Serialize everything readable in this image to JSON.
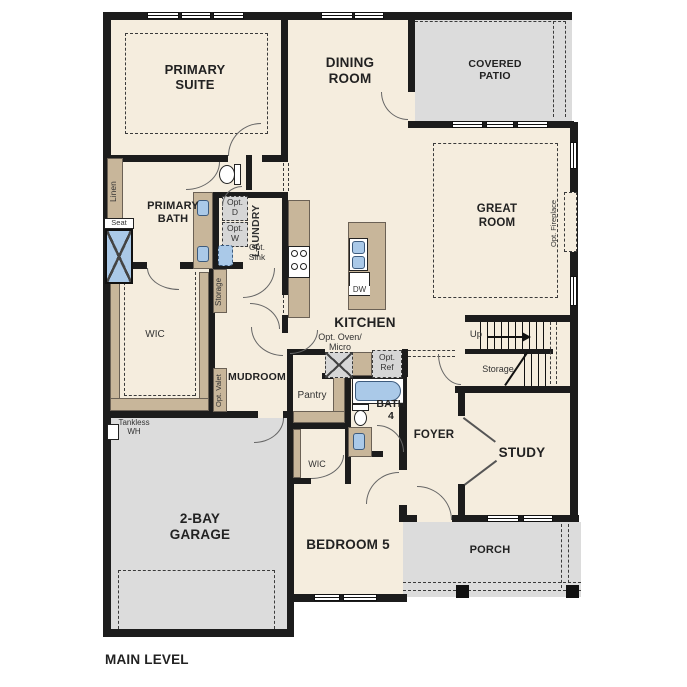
{
  "plan": {
    "title": "MAIN LEVEL",
    "rooms": {
      "primary_suite": "PRIMARY SUITE",
      "dining_room": "DINING ROOM",
      "covered_patio": "COVERED PATIO",
      "great_room": "GREAT ROOM",
      "primary_bath": "PRIMARY BATH",
      "laundry": "LAUNDRY",
      "wic_primary": "WIC",
      "kitchen": "KITCHEN",
      "mudroom": "MUDROOM",
      "pantry": "Pantry",
      "bath4": "BATH 4",
      "wic_bed5": "WIC",
      "foyer": "FOYER",
      "study": "STUDY",
      "bedroom5": "BEDROOM 5",
      "garage": "2-BAY GARAGE",
      "porch": "PORCH"
    },
    "annotations": {
      "linen": "Linen",
      "seat": "Seat",
      "opt_d": "Opt. D",
      "opt_w": "Opt. W",
      "opt_sink": "Opt. Sink",
      "storage_laundry": "Storage",
      "opt_valet": "Opt. Valet",
      "opt_oven_micro": "Opt. Oven/ Micro",
      "opt_ref": "Opt. Ref",
      "dw": "DW",
      "up": "Up",
      "storage_stairs": "Storage",
      "opt_fireplace": "Opt. Fireplace",
      "tankless_wh": "Tankless WH"
    },
    "colors": {
      "floor": "#f5edde",
      "outdoor": "#dcdcdc",
      "cabinet": "#c8b69a",
      "fixture_blue": "#aac9e8",
      "wall": "#1c1c1c"
    }
  }
}
